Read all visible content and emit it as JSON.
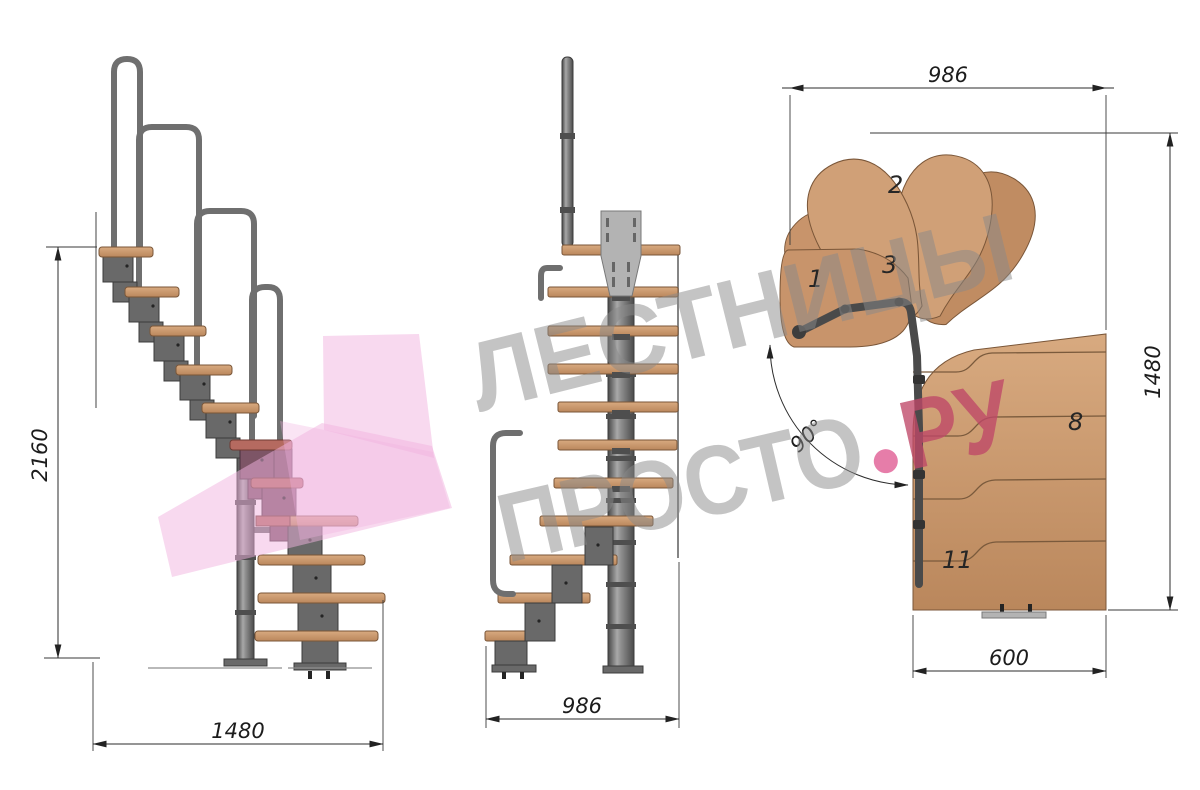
{
  "watermark": {
    "line1": "ЛЕСТНИЦЫ",
    "line2_word": "ПРОСТО",
    "line2_tld": "РУ",
    "gray_color": "#8a8a8a",
    "accent_color": "#bf4868",
    "dot_color": "#e05c94"
  },
  "side_view": {
    "label": "side-elevation",
    "height_mm": "2160",
    "run_mm": "1480"
  },
  "front_view": {
    "label": "front-elevation",
    "width_mm": "986"
  },
  "plan_view": {
    "label": "plan-top-view",
    "top_mm": "986",
    "right_mm": "1480",
    "bottom_mm": "600",
    "turn_angle": "90°",
    "tread_numbers": [
      "1",
      "2",
      "3",
      "8",
      "11"
    ]
  },
  "palette": {
    "wood": "#c8946b",
    "wood_dark": "#a97c52",
    "metal": "#696969",
    "metal_light": "#b3b3b3",
    "highlight_pink": "#f2b3e0",
    "highlight_plum": "#8d5670",
    "dim_line": "#2b2b2b"
  }
}
